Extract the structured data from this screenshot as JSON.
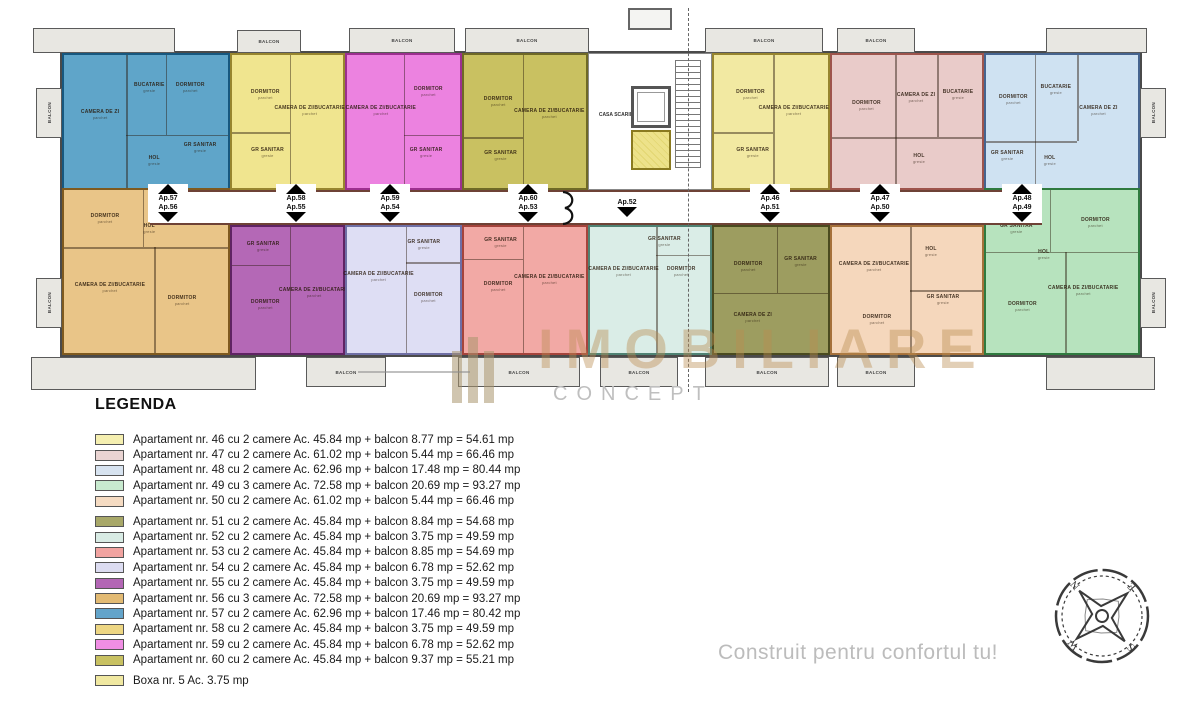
{
  "watermark": {
    "line1": "IMOBILIARE",
    "line2": "CONCEPT"
  },
  "slogan": "Construit pentru confortul tu!",
  "compass": {
    "letters": [
      "N",
      "E",
      "S",
      "W"
    ]
  },
  "plan": {
    "staircase_label": "CASA SCARII",
    "apartments": [
      {
        "id": "57",
        "x": 62,
        "y": 53,
        "w": 168,
        "h": 137,
        "fill": "#5fa5c9",
        "stroke": "#17587f",
        "dividers": [
          [
            "v",
            38,
            0,
            100
          ],
          [
            "v",
            62,
            0,
            60
          ],
          [
            "h",
            60,
            38,
            100
          ]
        ],
        "rooms": [
          {
            "label": "CAMERA DE ZI",
            "sub": "parchet",
            "x": 22,
            "y": 45
          },
          {
            "label": "BUCATARIE",
            "sub": "gresie",
            "x": 52,
            "y": 25
          },
          {
            "label": "DORMITOR",
            "sub": "parchet",
            "x": 77,
            "y": 25
          },
          {
            "label": "HOL",
            "sub": "gresie",
            "x": 55,
            "y": 80
          },
          {
            "label": "GR SANITAR",
            "sub": "gresie",
            "x": 83,
            "y": 70
          }
        ]
      },
      {
        "id": "58",
        "x": 230,
        "y": 53,
        "w": 115,
        "h": 137,
        "fill": "#f0e58f",
        "stroke": "#97852f",
        "dividers": [
          [
            "v",
            52,
            0,
            100
          ],
          [
            "h",
            58,
            0,
            52
          ]
        ],
        "rooms": [
          {
            "label": "DORMITOR",
            "sub": "parchet",
            "x": 30,
            "y": 30
          },
          {
            "label": "CAMERA DE ZI/BUCATARIE",
            "sub": "parchet",
            "x": 70,
            "y": 42
          },
          {
            "label": "GR SANITAR",
            "sub": "gresie",
            "x": 32,
            "y": 74
          }
        ]
      },
      {
        "id": "59",
        "x": 345,
        "y": 53,
        "w": 117,
        "h": 137,
        "fill": "#ec82e0",
        "stroke": "#9c2f8f",
        "dividers": [
          [
            "v",
            50,
            0,
            100
          ],
          [
            "h",
            60,
            50,
            100
          ]
        ],
        "rooms": [
          {
            "label": "CAMERA DE ZI/BUCATARIE",
            "sub": "parchet",
            "x": 30,
            "y": 42
          },
          {
            "label": "DORMITOR",
            "sub": "parchet",
            "x": 72,
            "y": 28
          },
          {
            "label": "GR SANITAR",
            "sub": "gresie",
            "x": 70,
            "y": 74
          }
        ]
      },
      {
        "id": "60",
        "x": 462,
        "y": 53,
        "w": 126,
        "h": 137,
        "fill": "#c9c161",
        "stroke": "#6f6926",
        "dividers": [
          [
            "v",
            48,
            0,
            100
          ],
          [
            "h",
            62,
            0,
            48
          ]
        ],
        "rooms": [
          {
            "label": "DORMITOR",
            "sub": "parchet",
            "x": 28,
            "y": 35
          },
          {
            "label": "CAMERA DE ZI/BUCATARIE",
            "sub": "parchet",
            "x": 70,
            "y": 44
          },
          {
            "label": "GR SANITAR",
            "sub": "gresie",
            "x": 30,
            "y": 76
          }
        ]
      },
      {
        "id": "46",
        "x": 712,
        "y": 53,
        "w": 118,
        "h": 137,
        "fill": "#f2e9a2",
        "stroke": "#97852f",
        "dividers": [
          [
            "v",
            52,
            0,
            100
          ],
          [
            "h",
            58,
            0,
            52
          ]
        ],
        "rooms": [
          {
            "label": "DORMITOR",
            "sub": "parchet",
            "x": 32,
            "y": 30
          },
          {
            "label": "CAMERA DE ZI/BUCATARIE",
            "sub": "parchet",
            "x": 70,
            "y": 42
          },
          {
            "label": "GR SANITAR",
            "sub": "gresie",
            "x": 34,
            "y": 74
          }
        ]
      },
      {
        "id": "47",
        "x": 830,
        "y": 53,
        "w": 154,
        "h": 137,
        "fill": "#e9cbc9",
        "stroke": "#9e544c",
        "dividers": [
          [
            "v",
            42,
            0,
            100
          ],
          [
            "v",
            70,
            0,
            62
          ],
          [
            "h",
            62,
            0,
            100
          ]
        ],
        "rooms": [
          {
            "label": "DORMITOR",
            "sub": "parchet",
            "x": 23,
            "y": 38
          },
          {
            "label": "CAMERA DE ZI",
            "sub": "parchet",
            "x": 56,
            "y": 32
          },
          {
            "label": "BUCATARIE",
            "sub": "gresie",
            "x": 84,
            "y": 30
          },
          {
            "label": "HOL",
            "sub": "gresie",
            "x": 58,
            "y": 78
          }
        ]
      },
      {
        "id": "48",
        "x": 984,
        "y": 53,
        "w": 156,
        "h": 137,
        "fill": "#cfe2f2",
        "stroke": "#46648f",
        "dividers": [
          [
            "v",
            32,
            0,
            100
          ],
          [
            "v",
            60,
            0,
            65
          ],
          [
            "h",
            65,
            0,
            60
          ]
        ],
        "rooms": [
          {
            "label": "DORMITOR",
            "sub": "parchet",
            "x": 18,
            "y": 34
          },
          {
            "label": "BUCATARIE",
            "sub": "gresie",
            "x": 46,
            "y": 26
          },
          {
            "label": "CAMERA DE ZI",
            "sub": "parchet",
            "x": 74,
            "y": 42
          },
          {
            "label": "HOL",
            "sub": "gresie",
            "x": 42,
            "y": 80
          },
          {
            "label": "GR SANITAR",
            "sub": "gresie",
            "x": 14,
            "y": 76
          }
        ]
      },
      {
        "id": "56",
        "x": 62,
        "y": 188,
        "w": 168,
        "h": 167,
        "fill": "#e9c588",
        "stroke": "#7f5a1f",
        "dividers": [
          [
            "h",
            35,
            0,
            100
          ],
          [
            "v",
            48,
            0,
            35
          ],
          [
            "v",
            55,
            35,
            100
          ]
        ],
        "rooms": [
          {
            "label": "DORMITOR",
            "sub": "parchet",
            "x": 25,
            "y": 18
          },
          {
            "label": "HOL",
            "sub": "gresie",
            "x": 52,
            "y": 24
          },
          {
            "label": "GR SANITAR",
            "sub": "gresie",
            "x": 78,
            "y": 16
          },
          {
            "label": "CAMERA DE ZI/BUCATARIE",
            "sub": "parchet",
            "x": 28,
            "y": 60
          },
          {
            "label": "DORMITOR",
            "sub": "parchet",
            "x": 72,
            "y": 68
          }
        ]
      },
      {
        "id": "55",
        "x": 230,
        "y": 225,
        "w": 115,
        "h": 130,
        "fill": "#b468b6",
        "stroke": "#5f2363",
        "dividers": [
          [
            "v",
            52,
            0,
            100
          ],
          [
            "h",
            30,
            0,
            52
          ]
        ],
        "rooms": [
          {
            "label": "GR SANITAR",
            "sub": "gresie",
            "x": 28,
            "y": 16
          },
          {
            "label": "DORMITOR",
            "sub": "parchet",
            "x": 30,
            "y": 62
          },
          {
            "label": "CAMERA DE ZI/BUCATARIE",
            "sub": "parchet",
            "x": 74,
            "y": 52
          }
        ]
      },
      {
        "id": "54",
        "x": 345,
        "y": 225,
        "w": 117,
        "h": 130,
        "fill": "#dedef4",
        "stroke": "#6f6fa5",
        "dividers": [
          [
            "v",
            52,
            0,
            100
          ],
          [
            "h",
            28,
            52,
            100
          ]
        ],
        "rooms": [
          {
            "label": "GR SANITAR",
            "sub": "gresie",
            "x": 68,
            "y": 14
          },
          {
            "label": "CAMERA DE ZI/BUCATARIE",
            "sub": "parchet",
            "x": 28,
            "y": 40
          },
          {
            "label": "DORMITOR",
            "sub": "parchet",
            "x": 72,
            "y": 56
          }
        ]
      },
      {
        "id": "53",
        "x": 462,
        "y": 225,
        "w": 126,
        "h": 130,
        "fill": "#f2a9a5",
        "stroke": "#a5443c",
        "dividers": [
          [
            "v",
            48,
            0,
            100
          ],
          [
            "h",
            25,
            0,
            48
          ]
        ],
        "rooms": [
          {
            "label": "GR SANITAR",
            "sub": "gresie",
            "x": 30,
            "y": 13
          },
          {
            "label": "DORMITOR",
            "sub": "parchet",
            "x": 28,
            "y": 48
          },
          {
            "label": "CAMERA DE ZI/BUCATARIE",
            "sub": "parchet",
            "x": 70,
            "y": 42
          }
        ]
      },
      {
        "id": "52",
        "x": 588,
        "y": 225,
        "w": 124,
        "h": 130,
        "fill": "#daede7",
        "stroke": "#4f8273",
        "dividers": [
          [
            "v",
            55,
            0,
            100
          ],
          [
            "h",
            22,
            55,
            100
          ]
        ],
        "rooms": [
          {
            "label": "GR SANITAR",
            "sub": "gresie",
            "x": 62,
            "y": 12
          },
          {
            "label": "CAMERA DE ZI/BUCATARIE",
            "sub": "parchet",
            "x": 28,
            "y": 36
          },
          {
            "label": "DORMITOR",
            "sub": "parchet",
            "x": 76,
            "y": 36
          }
        ]
      },
      {
        "id": "51",
        "x": 712,
        "y": 225,
        "w": 118,
        "h": 130,
        "fill": "#9d9d60",
        "stroke": "#4a4a1f",
        "dividers": [
          [
            "h",
            52,
            0,
            100
          ],
          [
            "v",
            55,
            0,
            52
          ]
        ],
        "rooms": [
          {
            "label": "DORMITOR",
            "sub": "parchet",
            "x": 30,
            "y": 32
          },
          {
            "label": "GR SANITAR",
            "sub": "gresie",
            "x": 76,
            "y": 28
          },
          {
            "label": "CAMERA DE ZI",
            "sub": "parchet",
            "x": 34,
            "y": 72
          }
        ]
      },
      {
        "id": "50",
        "x": 830,
        "y": 225,
        "w": 154,
        "h": 130,
        "fill": "#f5d7bc",
        "stroke": "#a5703a",
        "dividers": [
          [
            "v",
            52,
            0,
            100
          ],
          [
            "h",
            50,
            52,
            100
          ]
        ],
        "rooms": [
          {
            "label": "CAMERA DE ZI/BUCATARIE",
            "sub": "parchet",
            "x": 28,
            "y": 32
          },
          {
            "label": "HOL",
            "sub": "gresie",
            "x": 66,
            "y": 20
          },
          {
            "label": "GR SANITAR",
            "sub": "gresie",
            "x": 74,
            "y": 58
          },
          {
            "label": "DORMITOR",
            "sub": "parchet",
            "x": 30,
            "y": 74
          }
        ]
      },
      {
        "id": "49",
        "x": 984,
        "y": 188,
        "w": 156,
        "h": 167,
        "fill": "#b7e3be",
        "stroke": "#2f7a3f",
        "dividers": [
          [
            "h",
            38,
            0,
            100
          ],
          [
            "v",
            42,
            0,
            38
          ],
          [
            "v",
            52,
            38,
            100
          ]
        ],
        "rooms": [
          {
            "label": "GR SANITAR",
            "sub": "gresie",
            "x": 20,
            "y": 24
          },
          {
            "label": "DORMITOR",
            "sub": "parchet",
            "x": 72,
            "y": 20
          },
          {
            "label": "HOL",
            "sub": "gresie",
            "x": 38,
            "y": 40
          },
          {
            "label": "DORMITOR",
            "sub": "parchet",
            "x": 24,
            "y": 72
          },
          {
            "label": "CAMERA DE ZI/BUCATARIE",
            "sub": "parchet",
            "x": 64,
            "y": 62
          }
        ]
      }
    ],
    "entrances": [
      {
        "x": 168,
        "top": "Ap.57",
        "bottom": "Ap.56"
      },
      {
        "x": 296,
        "top": "Ap.58",
        "bottom": "Ap.55"
      },
      {
        "x": 390,
        "top": "Ap.59",
        "bottom": "Ap.54"
      },
      {
        "x": 528,
        "top": "Ap.60",
        "bottom": "Ap.53"
      },
      {
        "x": 627,
        "top": "",
        "bottom": "Ap.52"
      },
      {
        "x": 770,
        "top": "Ap.46",
        "bottom": "Ap.51"
      },
      {
        "x": 880,
        "top": "Ap.47",
        "bottom": "Ap.50"
      },
      {
        "x": 1022,
        "top": "Ap.48",
        "bottom": "Ap.49"
      }
    ],
    "balconies": [
      {
        "x": 33,
        "y": 28,
        "w": 142,
        "h": 25,
        "label": ""
      },
      {
        "x": 237,
        "y": 30,
        "w": 64,
        "h": 23,
        "label": "BALCON"
      },
      {
        "x": 349,
        "y": 28,
        "w": 106,
        "h": 25,
        "label": "BALCON"
      },
      {
        "x": 465,
        "y": 28,
        "w": 124,
        "h": 25,
        "label": "BALCON"
      },
      {
        "x": 705,
        "y": 28,
        "w": 118,
        "h": 25,
        "label": "BALCON"
      },
      {
        "x": 837,
        "y": 28,
        "w": 78,
        "h": 25,
        "label": "BALCON"
      },
      {
        "x": 1046,
        "y": 28,
        "w": 101,
        "h": 25,
        "label": ""
      },
      {
        "x": 31,
        "y": 357,
        "w": 225,
        "h": 33,
        "label": ""
      },
      {
        "x": 306,
        "y": 357,
        "w": 80,
        "h": 30,
        "label": "BALCON"
      },
      {
        "x": 458,
        "y": 357,
        "w": 122,
        "h": 30,
        "label": "BALCON"
      },
      {
        "x": 600,
        "y": 357,
        "w": 78,
        "h": 30,
        "label": "BALCON"
      },
      {
        "x": 705,
        "y": 357,
        "w": 124,
        "h": 30,
        "label": "BALCON"
      },
      {
        "x": 837,
        "y": 357,
        "w": 78,
        "h": 30,
        "label": "BALCON"
      },
      {
        "x": 1046,
        "y": 357,
        "w": 109,
        "h": 33,
        "label": ""
      },
      {
        "x": 36,
        "y": 88,
        "w": 26,
        "h": 50,
        "label": "BALCON",
        "vertical": true
      },
      {
        "x": 36,
        "y": 278,
        "w": 26,
        "h": 50,
        "label": "BALCON",
        "vertical": true
      },
      {
        "x": 1140,
        "y": 88,
        "w": 26,
        "h": 50,
        "label": "BALCON",
        "vertical": true
      },
      {
        "x": 1140,
        "y": 278,
        "w": 26,
        "h": 50,
        "label": "BALCON",
        "vertical": true
      }
    ]
  },
  "legend": {
    "title": "LEGENDA",
    "items": [
      {
        "color": "#f5efb0",
        "text": "Apartament nr. 46 cu 2 camere Ac. 45.84 mp + balcon 8.77 mp = 54.61 mp"
      },
      {
        "color": "#ead4d2",
        "text": "Apartament nr. 47 cu 2 camere Ac. 61.02 mp + balcon 5.44 mp = 66.46 mp"
      },
      {
        "color": "#d7e3f0",
        "text": "Apartament nr. 48 cu 2 camere Ac. 62.96 mp + balcon 17.48 mp = 80.44 mp"
      },
      {
        "color": "#c8eacf",
        "text": "Apartament nr. 49 cu 3 camere Ac. 72.58 mp + balcon 20.69 mp = 93.27 mp"
      },
      {
        "color": "#f5dbc2",
        "text": "Apartament nr. 50 cu 2 camere Ac. 61.02 mp + balcon 5.44 mp = 66.46 mp"
      },
      {
        "color": "#a8a869",
        "text": "Apartament nr. 51 cu 2 camere Ac. 45.84 mp + balcon 8.84 mp = 54.68 mp",
        "gap": true
      },
      {
        "color": "#d8ebe4",
        "text": "Apartament nr. 52 cu 2 camere Ac. 45.84 mp + balcon 3.75 mp = 49.59 mp"
      },
      {
        "color": "#f1a3a0",
        "text": "Apartament nr. 53 cu 2 camere Ac. 45.84 mp + balcon 8.85 mp = 54.69 mp"
      },
      {
        "color": "#dcdcf1",
        "text": "Apartament nr. 54 cu 2 camere Ac. 45.84 mp + balcon 6.78 mp = 52.62 mp"
      },
      {
        "color": "#b366b5",
        "text": "Apartament nr. 55 cu 2 camere Ac. 45.84 mp + balcon 3.75 mp = 49.59 mp"
      },
      {
        "color": "#e2ba73",
        "text": "Apartament nr. 56 cu 3 camere Ac. 72.58 mp + balcon 20.69 mp = 93.27 mp"
      },
      {
        "color": "#63a4ca",
        "text": "Apartament nr. 57 cu 2 camere Ac. 62.96 mp + balcon 17.46 mp = 80.42 mp"
      },
      {
        "color": "#edd683",
        "text": "Apartament nr. 58 cu 2 camere Ac. 45.84 mp + balcon 3.75 mp = 49.59 mp"
      },
      {
        "color": "#f08ee4",
        "text": "Apartament nr. 59 cu 2 camere Ac. 45.84 mp + balcon 6.78 mp = 52.62 mp"
      },
      {
        "color": "#c8c162",
        "text": "Apartament nr. 60 cu 2 camere Ac. 45.84 mp + balcon 9.37 mp = 55.21 mp"
      },
      {
        "color": "#f0e8a1",
        "text": "Boxa nr. 5  Ac. 3.75 mp",
        "gap": true
      }
    ]
  }
}
